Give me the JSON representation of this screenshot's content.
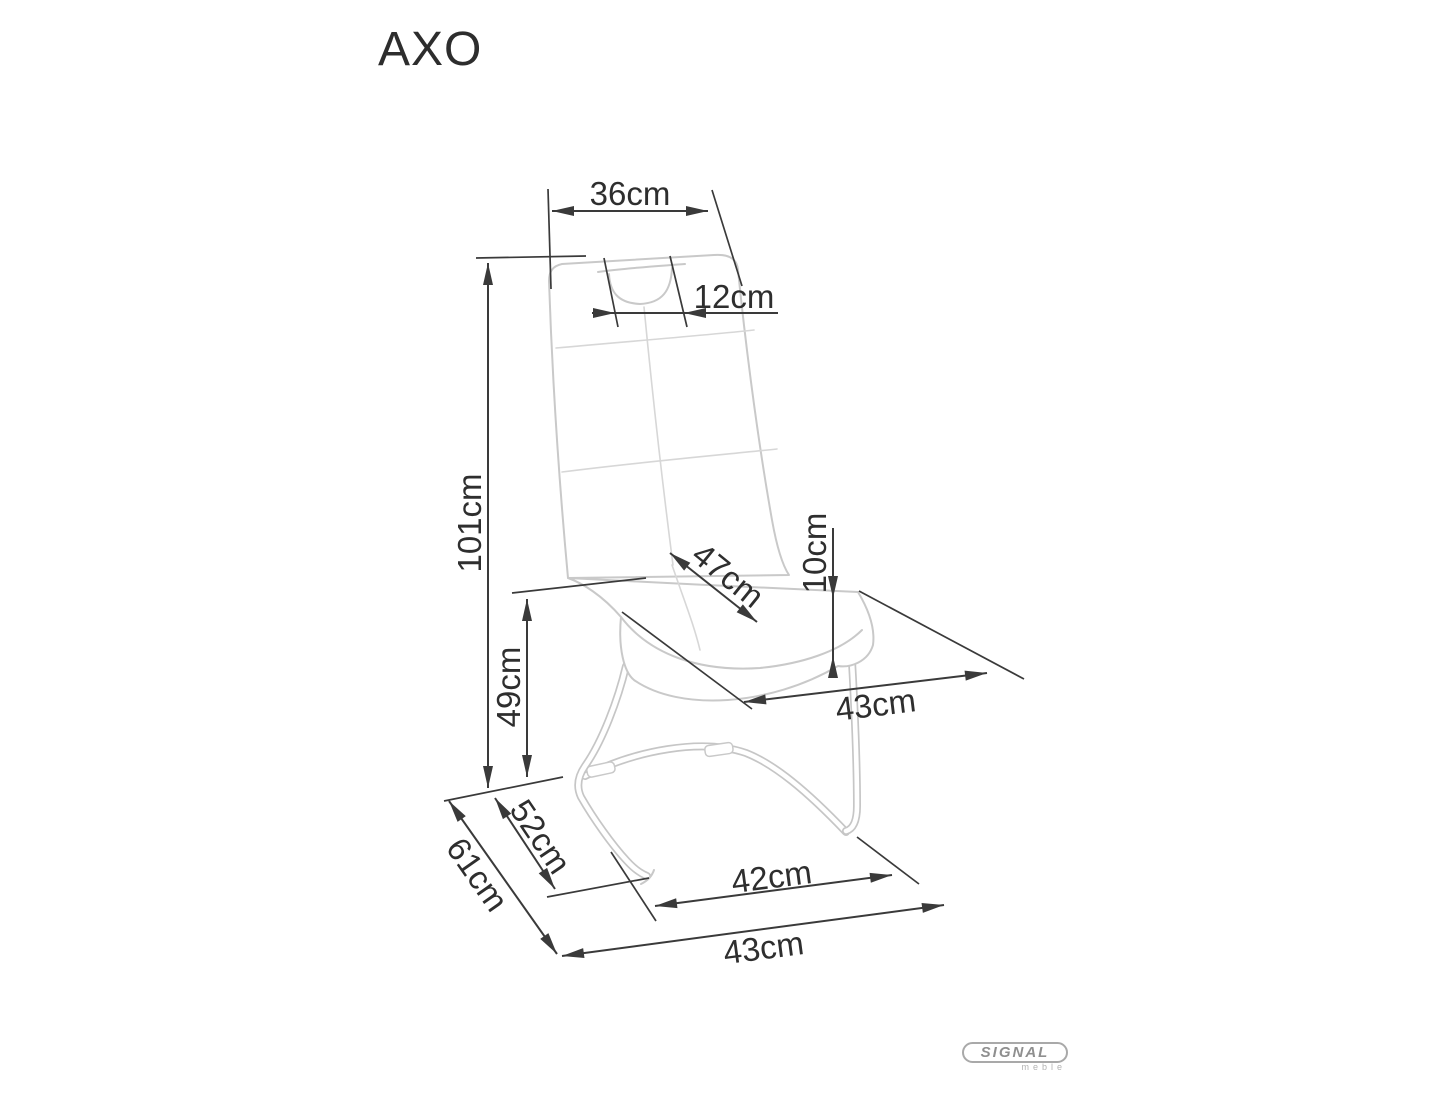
{
  "title": "AXO",
  "dimensions": {
    "backrest_top_width": "36cm",
    "handle_width": "12cm",
    "total_height": "101cm",
    "seat_depth": "47cm",
    "seat_cushion_thickness": "10cm",
    "seat_height": "49cm",
    "seat_width": "43cm",
    "base_side_inner_depth": "52cm",
    "base_side_outer_depth": "61cm",
    "base_front_inner_width": "42cm",
    "base_front_outer_width": "43cm"
  },
  "logo": {
    "brand": "SIGNAL",
    "subbrand": "meble"
  }
}
